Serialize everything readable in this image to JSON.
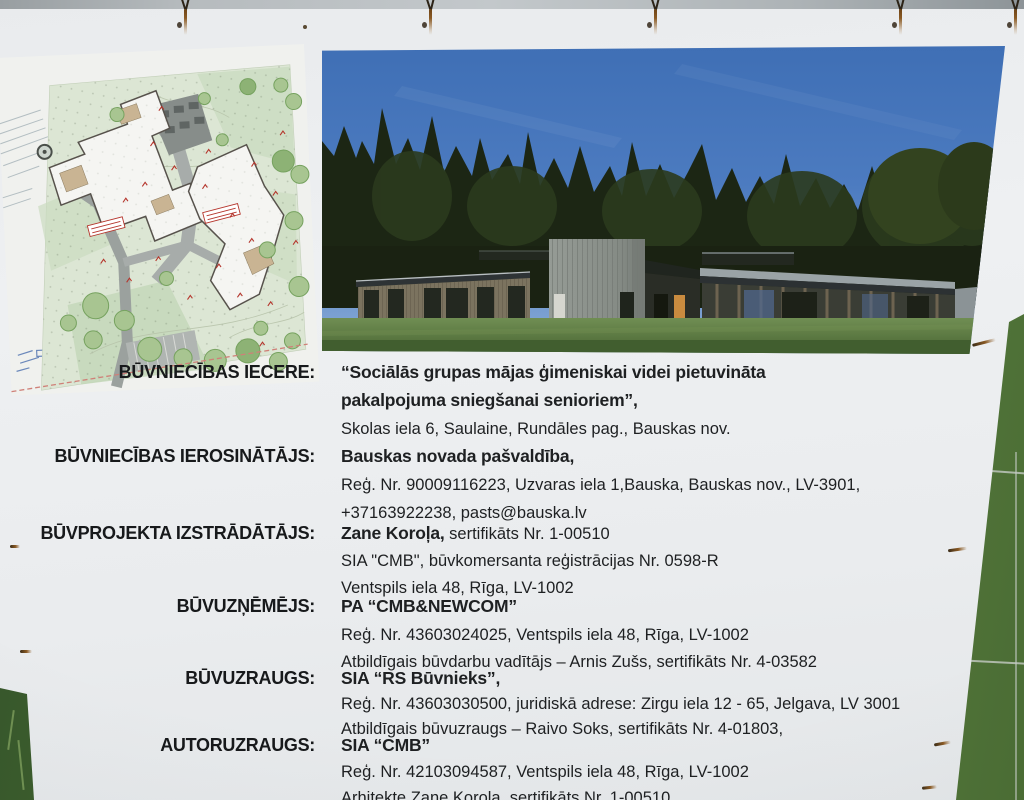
{
  "board_title_context": "construction information board",
  "colors": {
    "board_bg": "#eceef0",
    "text": "#1e2022",
    "sky_blue": "#4b79bd",
    "forest_dark": "#1c2614",
    "lawn_green": "#57743f",
    "plan_green": "#dce6d4",
    "plan_accent_red": "#b5352c",
    "rust": "#8a5a24"
  },
  "blocks": [
    {
      "label": "BŪVNIECĪBAS IECERE:",
      "l1b": "“Sociālās grupas mājas ģimeniskai videi pietuvināta",
      "l1n": "",
      "l2b": "pakalpojuma sniegšanai senioriem”,",
      "l2n": "",
      "l3b": "",
      "l3n": "Skolas iela 6, Saulaine, Rundāles pag., Bauskas nov."
    },
    {
      "label": "BŪVNIECĪBAS IEROSINĀTĀJS:",
      "l1b": "Bauskas novada pašvaldība,",
      "l1n": "",
      "l2b": "",
      "l2n": "Reģ. Nr. 90009116223, Uzvaras iela 1,Bauska, Bauskas nov., LV-3901,",
      "l3b": "",
      "l3n": "+37163922238, pasts@bauska.lv"
    },
    {
      "label": "BŪVPROJEKTA IZSTRĀDĀTĀJS:",
      "l1b": "Zane Koroļa,",
      "l1n": " sertifikāts Nr. 1-00510",
      "l2b": "",
      "l2n": "SIA \"CMB\", būvkomersanta reģistrācijas Nr. 0598-R",
      "l3b": "",
      "l3n": "Ventspils iela 48, Rīga, LV-1002"
    },
    {
      "label": "BŪVUZŅĒMĒJS:",
      "l1b": "PA “CMB&NEWCOM”",
      "l1n": "",
      "l2b": "",
      "l2n": "Reģ. Nr. 43603024025, Ventspils iela 48, Rīga, LV-1002",
      "l3b": "",
      "l3n": "Atbildīgais būvdarbu vadītājs – Arnis Zušs, sertifikāts Nr. 4-03582"
    },
    {
      "label": "BŪVUZRAUGS:",
      "l1b": "SIA “RS Būvnieks”,",
      "l1n": "",
      "l2b": "",
      "l2n": "Reģ. Nr. 43603030500, juridiskā adrese: Zirgu iela 12 - 65, Jelgava, LV 3001",
      "l3b": "",
      "l3n": "Atbildīgais būvuzraugs – Raivo Soks, sertifikāts Nr. 4-01803,"
    },
    {
      "label": "AUTORUZRAUGS:",
      "l1b": "SIA “CMB”",
      "l1n": "",
      "l2b": "",
      "l2n": "Reģ. Nr. 42103094587, Ventspils iela 48, Rīga, LV-1002",
      "l3b": "",
      "l3n": "Arhitekte Zane Koroļa, sertifikāts Nr. 1-00510"
    }
  ]
}
